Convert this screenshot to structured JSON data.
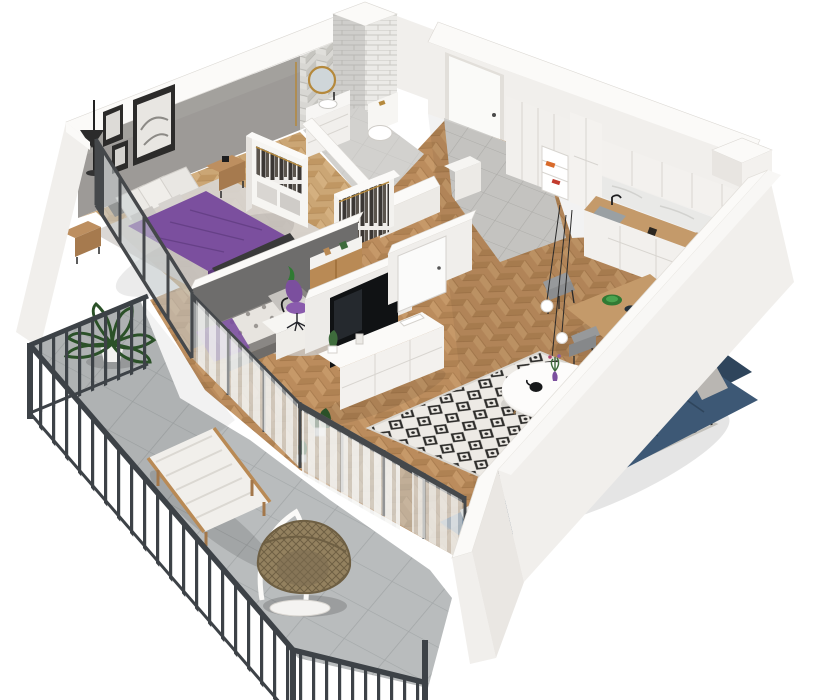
{
  "title": "3D apartment floor plan render",
  "view": "isometric cutaway, viewed from the south, white background",
  "palette": {
    "wallWhite": "#f1efec",
    "wallTop": "#fbfaf8",
    "wallShade": "#e3e0db",
    "grayWall": "#9d9a97",
    "darkWall": "#6e6d6c",
    "woodFloor": "#bb8c5d",
    "woodLight": "#cda271",
    "woodDark": "#a3774a",
    "bedroomWood": "#cba675",
    "purple": "#7b4f9e",
    "purpleDark": "#5e3a7d",
    "navy": "#3d5875",
    "navyDark": "#2f455c",
    "navyLight": "#4c6885",
    "rugLight": "#edeae5",
    "rugDark": "#2e2d2b",
    "balconyTile": "#b9bcbd",
    "balconyTileDark": "#a3a7a8",
    "railing": "#3d4247",
    "curtain": "#f2f2f0",
    "glass": "#c8cfd2",
    "plant": "#3e6b3c",
    "plantDark": "#2b5128",
    "gold": "#b5893c",
    "tileWall": "#d8d7d3",
    "tileWallDark": "#c6c5c0",
    "marble": "#e9e9e7",
    "counterWood": "#c49a6a",
    "chairGray": "#97999b",
    "black": "#17181a",
    "grayRug": "#d8d5d1"
  },
  "rooms": {
    "bedroom": {
      "label": "Bedroom",
      "furniture": [
        "double bed with purple duvet",
        "white pillows",
        "two wooden nightstands",
        "alarm clock",
        "black floor lamp",
        "three framed wall art pictures",
        "gray rug",
        "open wardrobe with clothes"
      ]
    },
    "kids_room": {
      "label": "Second room / office",
      "furniture": [
        "daybed with patterned bedding",
        "gray cushions",
        "purple throw",
        "white desk",
        "purple swivel chair",
        "desk lamp",
        "round gray rug",
        "wooden wardrobe"
      ]
    },
    "bathroom": {
      "label": "Bathroom",
      "furniture": [
        "round gold mirror",
        "white vanity with sink",
        "wall hung toilet with gold flush",
        "herringbone tiled walls",
        "white subway tile chimney column"
      ]
    },
    "hall": {
      "label": "Entry hall",
      "furniture": [
        "white entrance door",
        "tall white wardrobes",
        "open shelf with shoe boxes",
        "open clothes rail",
        "white interior door",
        "gray floor tiles"
      ]
    },
    "kitchen": {
      "label": "Kitchen / dining",
      "furniture": [
        "white shaker cabinets",
        "wooden worktop",
        "sink with black tap",
        "marble backsplash",
        "black coffee machine",
        "wooden dining table",
        "green plates",
        "gray dining chairs",
        "three globe pendant lights",
        "ventilation shaft"
      ]
    },
    "living_room": {
      "label": "Living room",
      "furniture": [
        "white TV sideboard",
        "black TV on low partition",
        "navy corner sofa",
        "gray white and purple cushions",
        "round white coffee table",
        "purple vase with flowers",
        "black teapot",
        "black and white diamond rug",
        "sheer curtains",
        "glass sliding wall",
        "potted plants"
      ]
    },
    "balcony": {
      "label": "Balcony",
      "furniture": [
        "gray concrete tiles",
        "charcoal metal railing",
        "fern in white pot",
        "wooden lounger with white cushion",
        "hanging rattan egg chair on white stand"
      ]
    }
  },
  "floor": {
    "main": "herringbone oak",
    "bedroom": "light herringbone oak",
    "bathroom": "light gray tile",
    "entry": "gray tile",
    "balcony": "large gray concrete tiles"
  }
}
